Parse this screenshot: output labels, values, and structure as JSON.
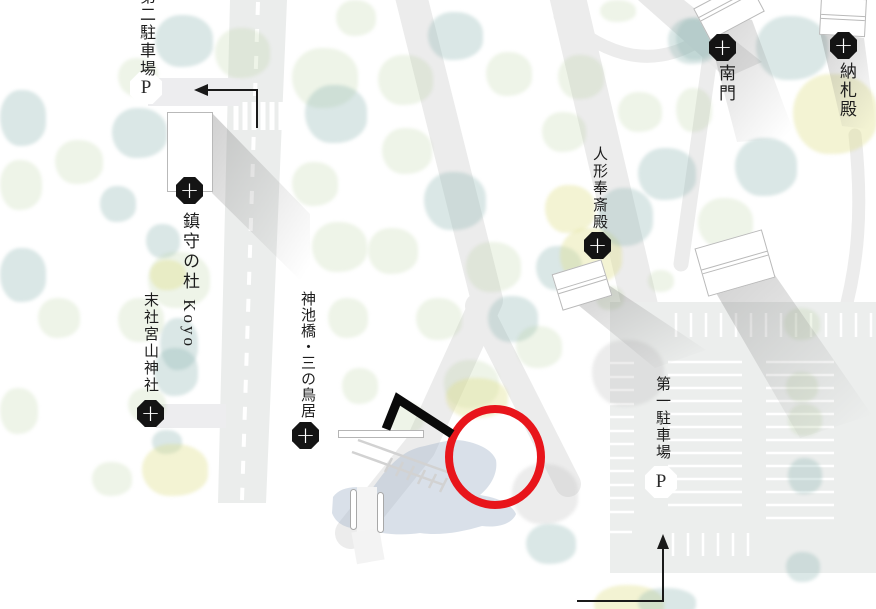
{
  "map_title": "shrine grounds illustrated map",
  "glyphs": {
    "plus": "+",
    "parking": "P"
  },
  "colors": {
    "highlight_red": "#e8151b",
    "marker_black": "#141414",
    "road_gray": "#ececec",
    "parking_gray": "#eceeed",
    "pond_blue": "#a4b5ca",
    "tree_teal": "#8bb5b1",
    "tree_green": "#b0cd96",
    "tree_yellow": "#dfdf8c",
    "arrow_black": "#1a1a1a"
  },
  "pois": [
    {
      "id": "daini-chushajo",
      "label": "第二駐車場",
      "marker": "P"
    },
    {
      "id": "chinju-no-mori",
      "label": "鎮守の杜 Koyo",
      "marker": "+"
    },
    {
      "id": "massha-miyayama-jinja",
      "label": "末社宮山神社",
      "marker": "+"
    },
    {
      "id": "shinchikebashi-sannotorii",
      "label": "神池橋・三の鳥居",
      "marker": "+"
    },
    {
      "id": "ningyo-hosaiden",
      "label": "人形奉斎殿",
      "marker": "+"
    },
    {
      "id": "nanmon",
      "label": "南門",
      "marker": "+"
    },
    {
      "id": "nosatsuden",
      "label": "納札殿",
      "marker": "+"
    },
    {
      "id": "daiichi-chushajo",
      "label": "第一駐車場",
      "marker": "P"
    }
  ]
}
